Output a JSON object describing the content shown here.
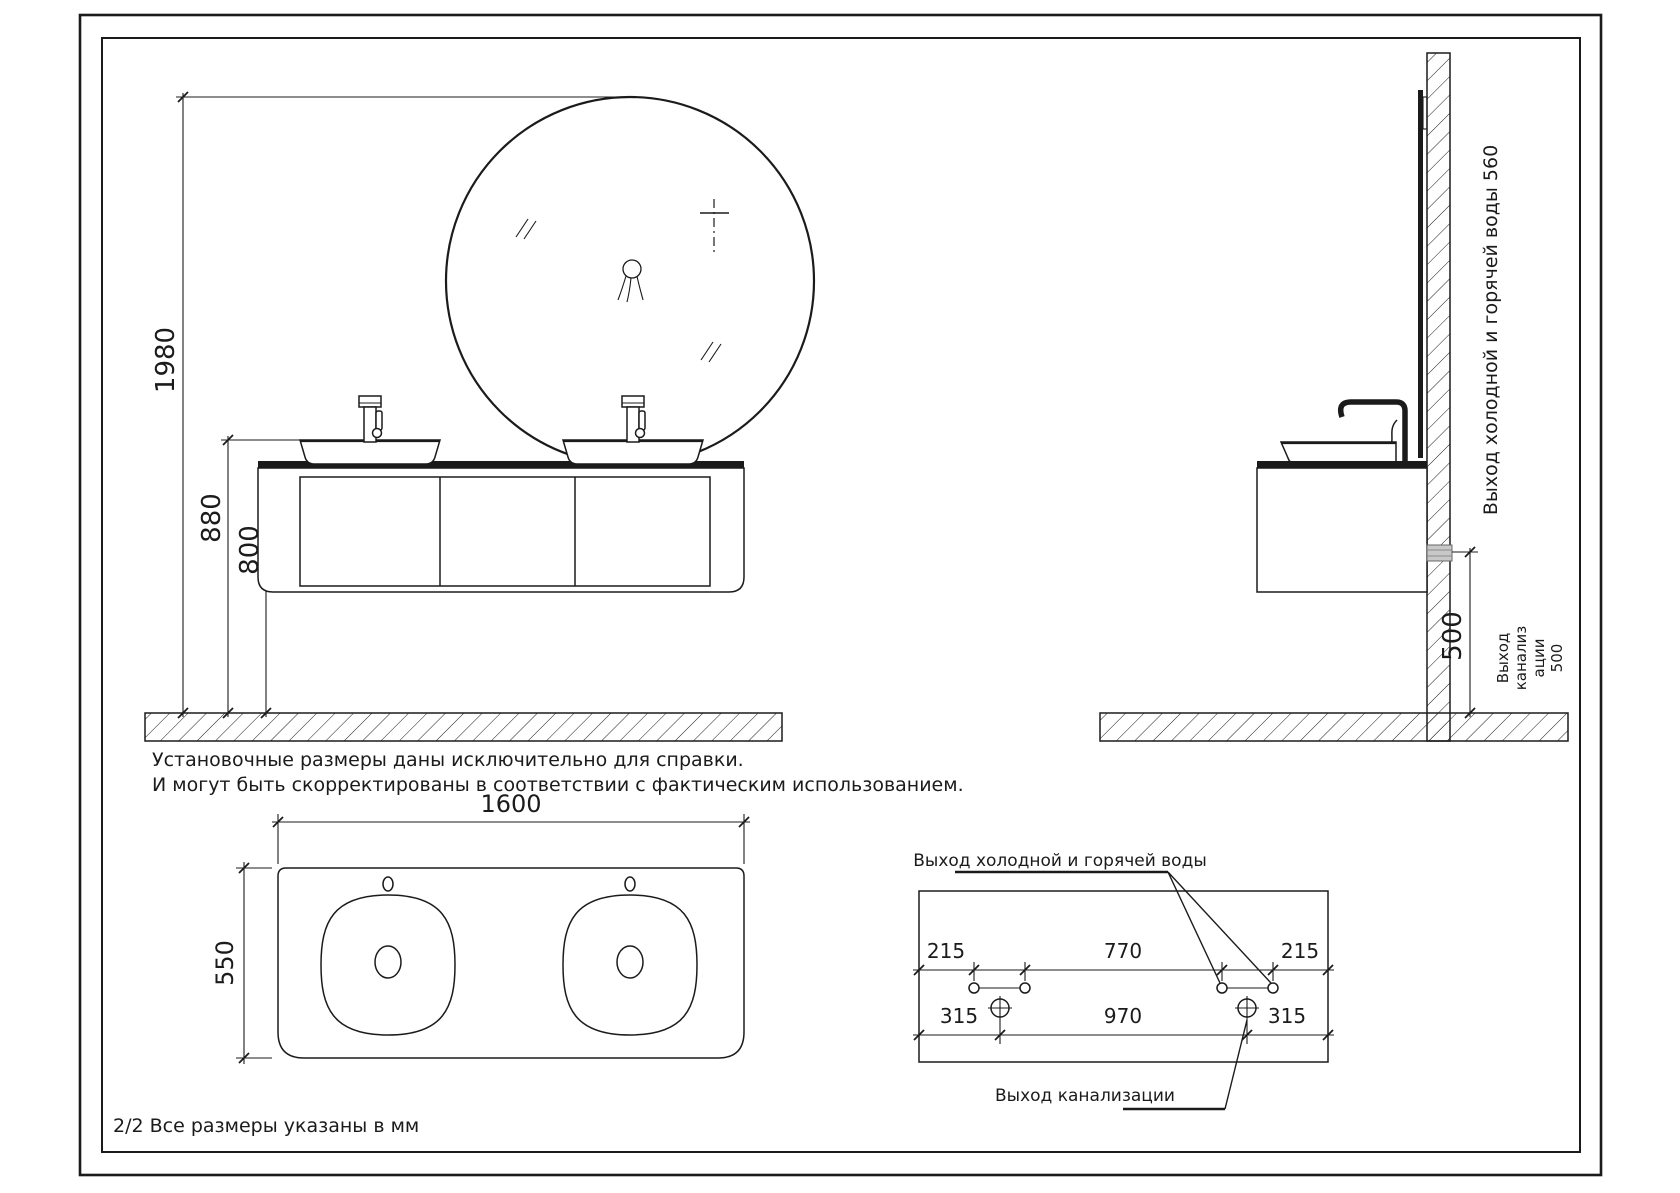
{
  "title_block": {
    "footer": "2/2 Все размеры указаны в мм"
  },
  "note": {
    "line1": "Установочные размеры даны исключительно для справки.",
    "line2": "И могут быть скорректированы в соответствии с фактическим использованием."
  },
  "front_view": {
    "dim_height_total": "1980",
    "dim_height_sink": "880",
    "dim_height_counter": "800"
  },
  "side_view": {
    "label_water": "Выход холодной и горячей воды 560",
    "dim_sewer": "500",
    "label_sewer_lines": [
      "Выход",
      "канализ",
      "ации",
      "500"
    ]
  },
  "top_view": {
    "dim_width": "1600",
    "dim_depth": "550"
  },
  "wall_layout": {
    "label_water": "Выход холодной и горячей воды",
    "label_sewer": "Выход канализации",
    "dim_top": [
      "215",
      "770",
      "215"
    ],
    "dim_bottom": [
      "315",
      "970",
      "315"
    ]
  },
  "colors": {
    "line": "#1b1b1b",
    "pipe_gray": "#c8c8c8",
    "background": "#ffffff"
  }
}
